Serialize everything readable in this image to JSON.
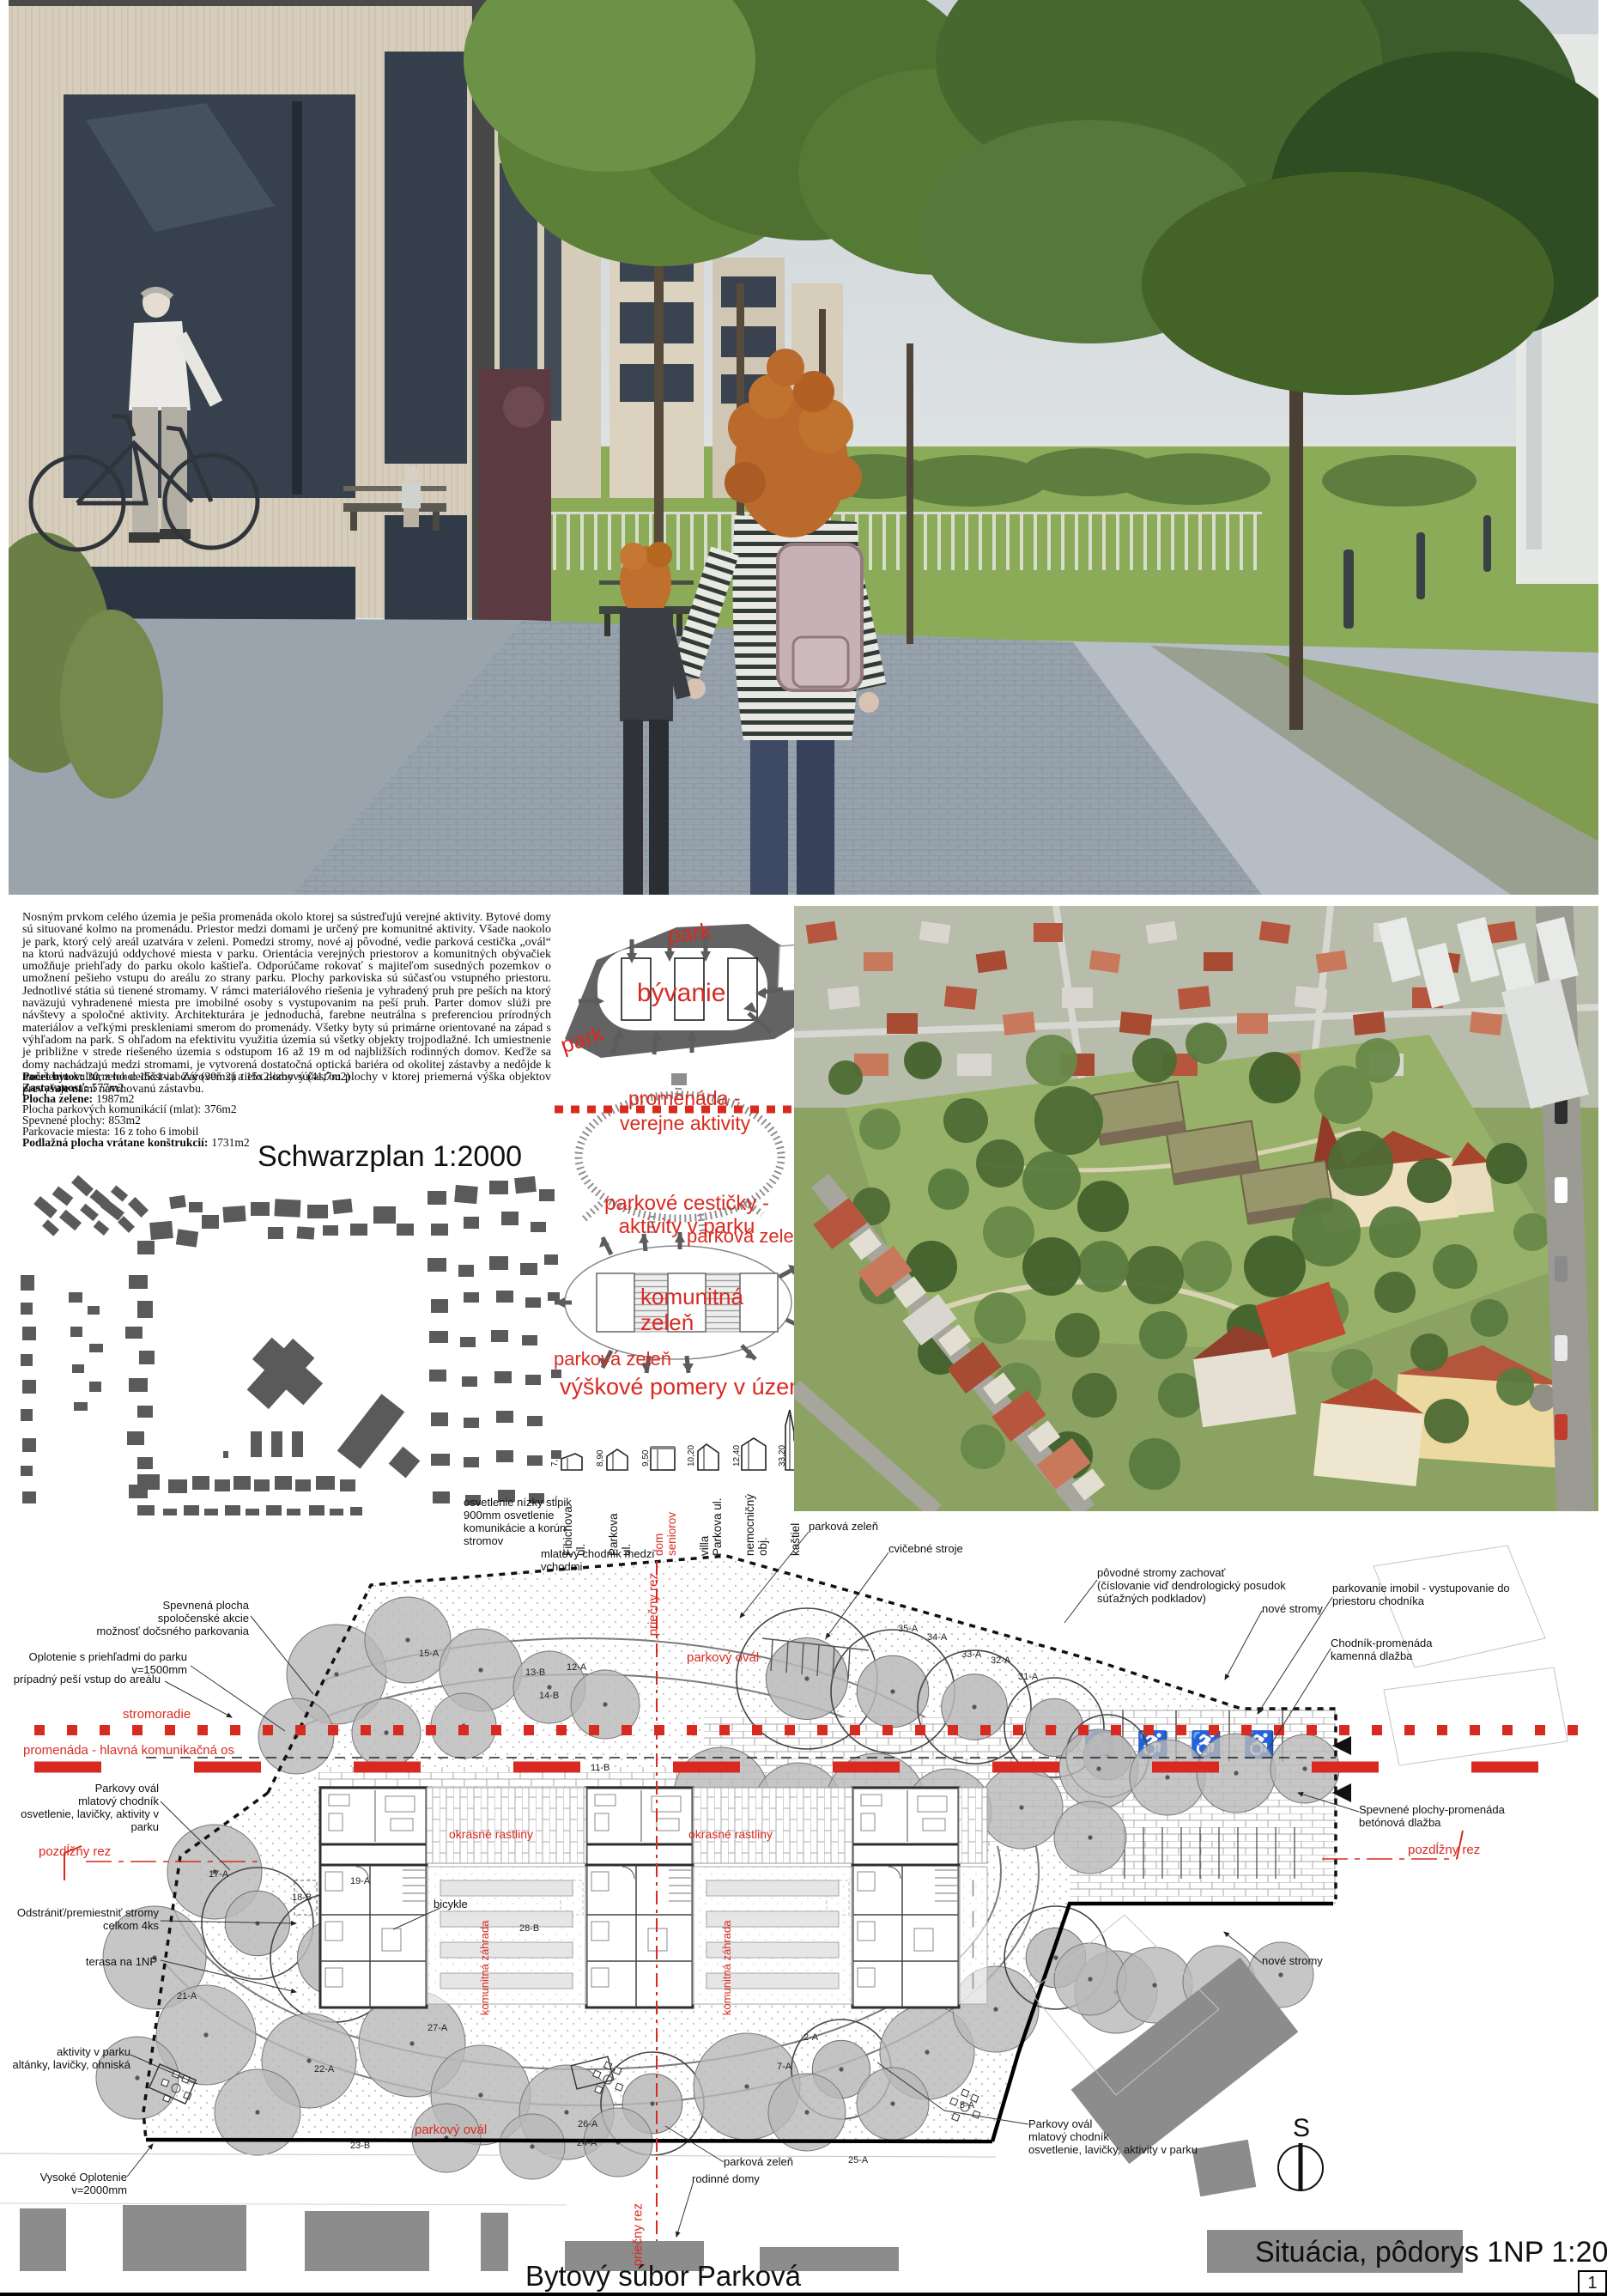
{
  "titles": {
    "schwarzplan": "Schwarzplan 1:2000",
    "situacia": "Situácia, pôdorys 1NP 1:200",
    "project": "Bytový súbor Parková",
    "page_number": "1"
  },
  "description": {
    "paragraph": "Nosným prvkom celého územia je pešia promenáda okolo ktorej sa sústreďujú verejné aktivity. Bytové domy sú situované kolmo na promenádu. Priestor medzi domami je určený pre komunitné aktivity. Všade naokolo je park, ktorý celý areál uzatvára v zeleni. Pomedzi stromy, nové aj pôvodné, vedie parková cestička „ovál“ na ktorú nadväzujú oddychové miesta v parku. Orientácia verejných priestorov a komunitných obývačiek umožňuje priehľady do parku okolo kaštieľa. Odporúčame rokovať s majiteľom susedných pozemkov o umožnení pešieho vstupu do areálu zo strany parku. Plochy parkoviska sú súčasťou vstupného priestoru. Jednotlivé státia sú tienené stromamy. V rámci materiálového riešenia je vyhradený pruh pre peších na ktorý naväzujú vyhradenené miesta pre imobilné osoby s vystupovanim na peší pruh. Parter domov slúži pre návštevy a spoločné aktivity. Architekturára je jednoduchá, farebne neutrálna s preferenciou prírodných materiálov a veľkými preskleniami smerom do promenády. Všetky byty sú primárne orientované na západ s výhľadom na park. S ohľadom na efektivitu využitia územia sú všetky objekty trojpodlažné. Ich umiestnenie je približne v strede riešeného územia s odstupom 16 až 19 m od najbližších rodinných domov. Keďže sa domy nachádzajú medzi stromami, je vytvorená dostatočná optická bariéra od okolitej zástavby a nedôjde k narušeniu kultúrneho dedičstva. Zároveň sú tieto domy súčasťou plochy v ktorej priemerná výška objektov prevyšuje nami navrhovanú zástavbu.",
    "stats": [
      {
        "label": "Počet bytov:",
        "value": "30, z toho: 15x1-izbový (30m2) a 15x2-izbový (41,7m2)"
      },
      {
        "label": "Zastavanosť:",
        "value": "577m2"
      },
      {
        "label": "Plocha zelene:",
        "value": "1987m2"
      },
      {
        "label": "Plocha parkových komunikácií (mlat):",
        "value": "376m2"
      },
      {
        "label": "Spevnené plochy:",
        "value": "853m2"
      },
      {
        "label": "Parkovacie miesta:",
        "value": "16 z toho 6 imobil"
      },
      {
        "label": "Podlažná plocha vrátane konštrukcií:",
        "value": "1731m2"
      }
    ]
  },
  "diagrams": {
    "housing": {
      "park_top": "park",
      "park_left": "park",
      "center": "bývanie"
    },
    "promenade": {
      "line1": "promenáda  -",
      "line2": "verejne aktivity",
      "caption_line1": "parkové cestičky -",
      "caption_line2": "aktivity v parku"
    },
    "greenery": {
      "center_line1": "komunitná",
      "center_line2": "zeleň",
      "label_top": "parková zeleň",
      "label_bottom": "parková zeleň"
    },
    "heights": {
      "title": "výškové pomery v území",
      "items": [
        {
          "name": "Fibichova\nul.",
          "h": "7,20"
        },
        {
          "name": "Parkova\nul.",
          "h": "8,90"
        },
        {
          "name": "dom\nseniorov",
          "h": "9,50"
        },
        {
          "name": "villa\nParkova ul.",
          "h": "10,20"
        },
        {
          "name": "nemocničný\nobj.",
          "h": "12,40"
        },
        {
          "name": "kaštiel",
          "h": "33,20"
        }
      ]
    }
  },
  "siteplan": {
    "annotations": {
      "spevnena_plocha": "Spevnená plocha\nspoločenské akcie\nmožnosť dočsného parkovania",
      "oplotenie": "Oplotenie s priehľadmi do parku\nv=1500mm",
      "pesi_vstup": "prípadný peší vstup do areálu",
      "parkovy_oval_l": "Parkovy ovál\nmlatový chodník\nosvetlenie, lavičky, aktivity v parku",
      "odstranit": "Odstrániť/premiestniť stromy\ncelkom 4ks",
      "terasa": "terasa na 1NP",
      "aktivity": "aktivity v parku\naltánky, lavičky, ohniská",
      "vysoke_oplotenie": "Vysoké Oplotenie\nv=2000mm",
      "osvetlenie": "osvetlenie nízky stĺpik\n900mm osvetlenie\nkomunikácie a korún\nstromov",
      "mlatovy_chodnik": "mlatový chodník medzi\nvchodmi",
      "povodne_stromy": "pôvodné stromy zachovať\n(číslovanie viď dendrologický posudok\nsúťažných podkladov)",
      "nove_stromy1": "nové stromy",
      "parkovanie_imobil": "parkovanie imobil - vystupovanie do\npriestoru chodníka",
      "chodnik": "Chodník-promenáda\nkamenná dlažba",
      "spevnene_plochy": "Spevnené plochy-promenáda\nbetónová dlažba",
      "nove_stromy2": "nové stromy",
      "parkovy_oval_r": "Parkovy ovál\nmlatový chodník\nosvetlenie, lavičky, aktivity v parku",
      "parkova_zelen_top": "parková zeleň",
      "cvicebne_stroje": "cvičebné stroje",
      "parkova_zelen_bottom": "parková zeleň",
      "rodinne_domy": "rodinné domy",
      "bicykle": "bicykle"
    },
    "red_labels": {
      "stromoradie": "stromoradie",
      "promenada": "promenáda - hlavná komunikačná os",
      "pozdlzny_l": "pozdĺžny rez",
      "pozdlzny_r": "pozdĺžny rez",
      "priecny_t": "priečny rez",
      "priecny_b": "priečny rez",
      "parkovy_oval_t": "parkový ovál",
      "parkovy_oval_b": "parkový ovál",
      "okrasne_1": "okrasné rastliny",
      "okrasne_2": "okrasné rastliny",
      "komunitna_1": "komunitná záhrada",
      "komunitna_2": "komunitná záhrada"
    },
    "tree_tags": [
      "15-A",
      "13-B",
      "12-A",
      "14-B",
      "11-B",
      "35-A",
      "34-A",
      "33-A",
      "32-A",
      "31-A",
      "17-A",
      "19-A",
      "18-B",
      "21-A",
      "28-B",
      "27-A",
      "22-A",
      "2-A",
      "7-A",
      "23-B",
      "26-A",
      "24-A",
      "25-A",
      "5-A"
    ],
    "compass": "S",
    "icons": {
      "wheelchair": "♿"
    }
  }
}
